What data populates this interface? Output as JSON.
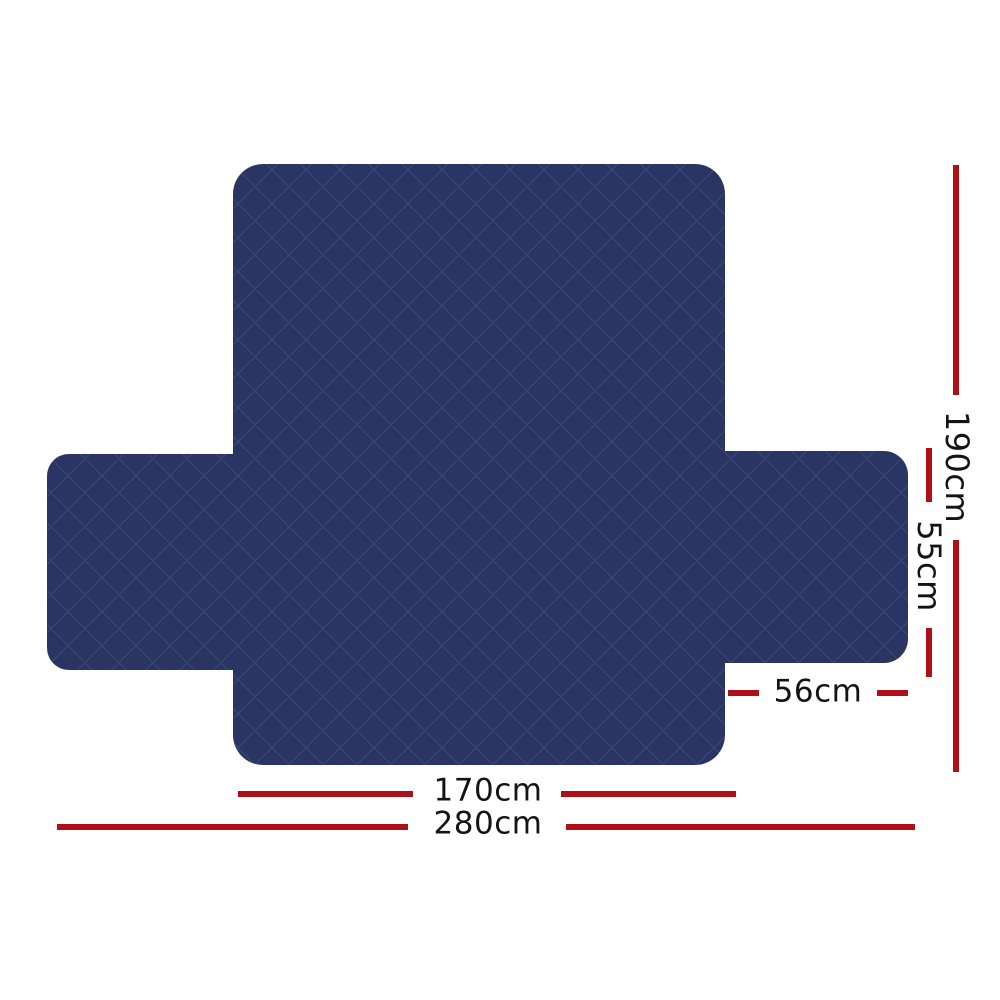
{
  "figure": {
    "type": "product-dimension-diagram",
    "subject": "diamond-quilted sofa couch cover shown flat (cross shape: back/seat panel with two side arm flaps)"
  },
  "colors": {
    "background": "#ffffff",
    "fabric_base": "#2b3564",
    "fabric_line": "#41507f",
    "fabric_shade": "#20294d",
    "dimension_line": "#ad1017",
    "label_text": "#141414"
  },
  "measurements": {
    "total_length": {
      "label": "190cm",
      "orientation": "vertical"
    },
    "side_flap_depth": {
      "label": "55cm",
      "orientation": "vertical"
    },
    "side_flap_width": {
      "label": "56cm",
      "orientation": "horizontal"
    },
    "panel_width": {
      "label": "170cm",
      "orientation": "horizontal"
    },
    "total_width": {
      "label": "280cm",
      "orientation": "horizontal"
    }
  }
}
